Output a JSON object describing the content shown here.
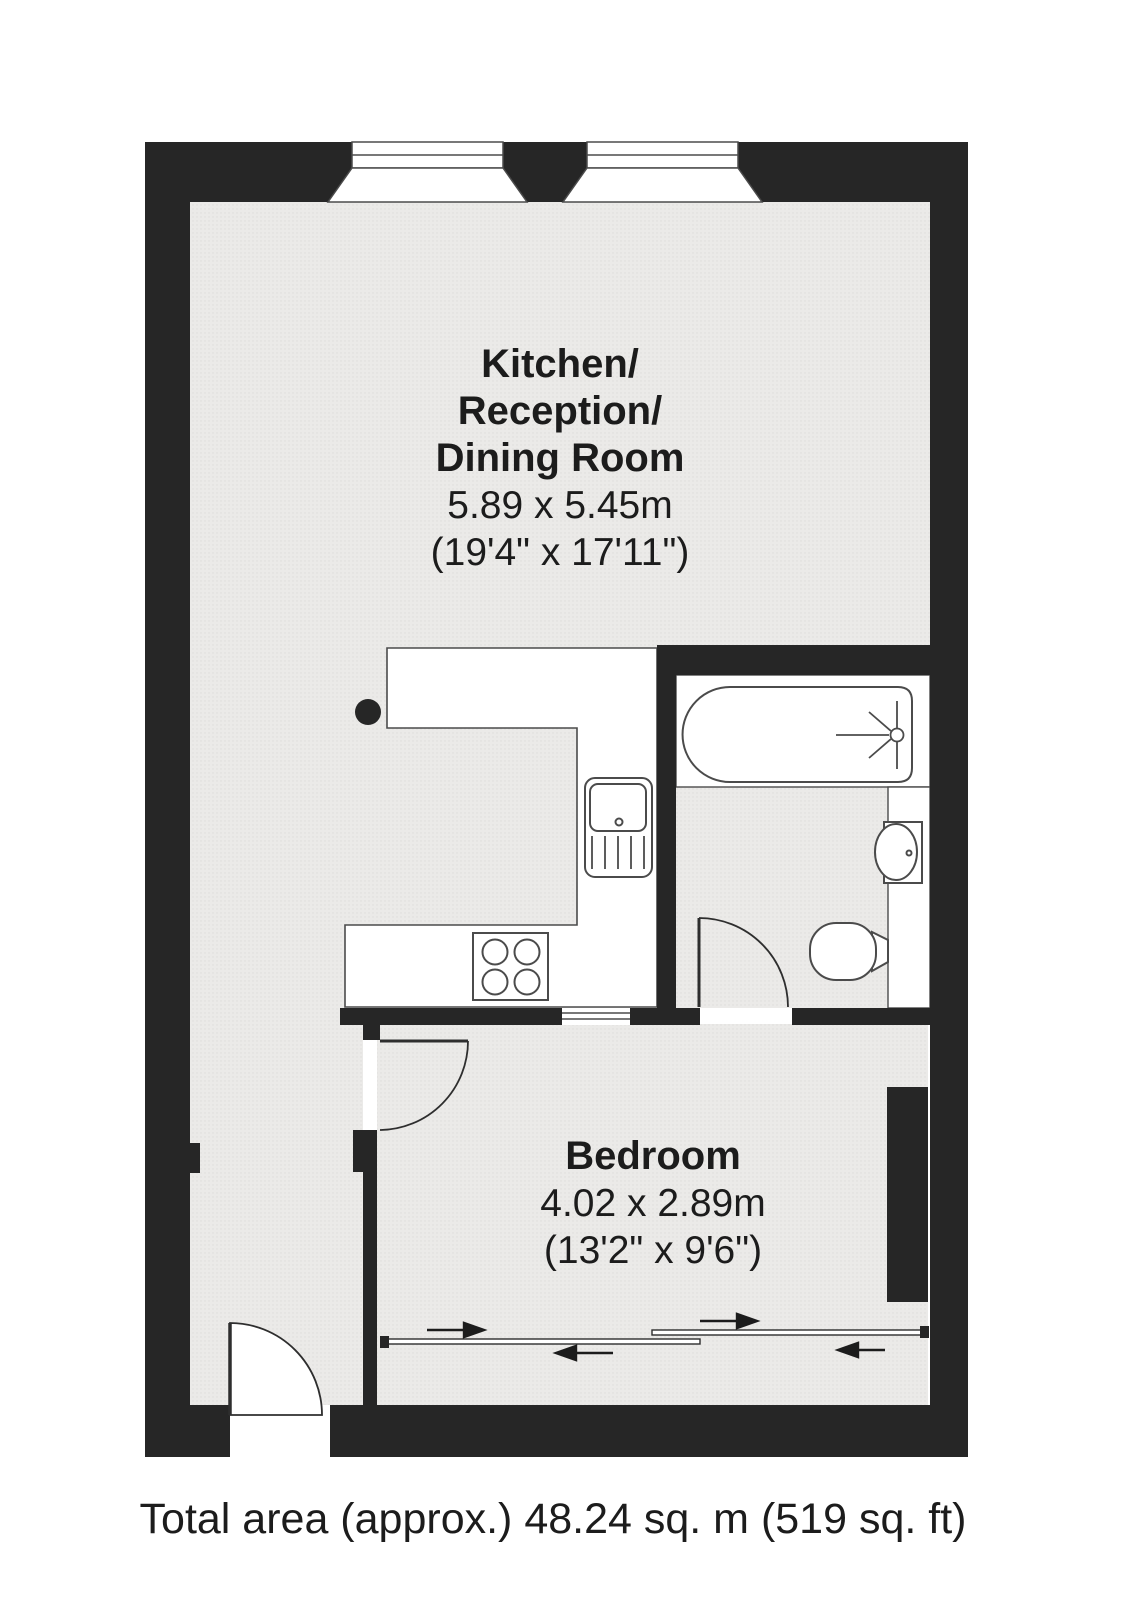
{
  "rooms": {
    "kitchen": {
      "name_line1": "Kitchen/",
      "name_line2": "Reception/",
      "name_line3": "Dining Room",
      "size_metric": "5.89 x 5.45m",
      "size_imperial": "(19'4\" x 17'11\")"
    },
    "bedroom": {
      "name": "Bedroom",
      "size_metric": "4.02 x 2.89m",
      "size_imperial": "(13'2\" x 9'6\")"
    }
  },
  "footer": {
    "total_area_text": "Total area (approx.) 48.24 sq. m (519 sq. ft)",
    "total_area_sqm": 48.24,
    "total_area_sqft": 519
  },
  "fixtures": [
    "bathtub-with-shower",
    "washbasin",
    "toilet",
    "kitchen-sink-with-drainer",
    "hob-4-rings",
    "sliding-wardrobe-doors",
    "bay-window-left",
    "bay-window-right"
  ],
  "colors": {
    "wall": "#262626",
    "floor": "#ebeae8",
    "floor_dot": "#dedddb",
    "line": "#4b4b4b",
    "text": "#1c1c1c",
    "background": "#ffffff"
  }
}
